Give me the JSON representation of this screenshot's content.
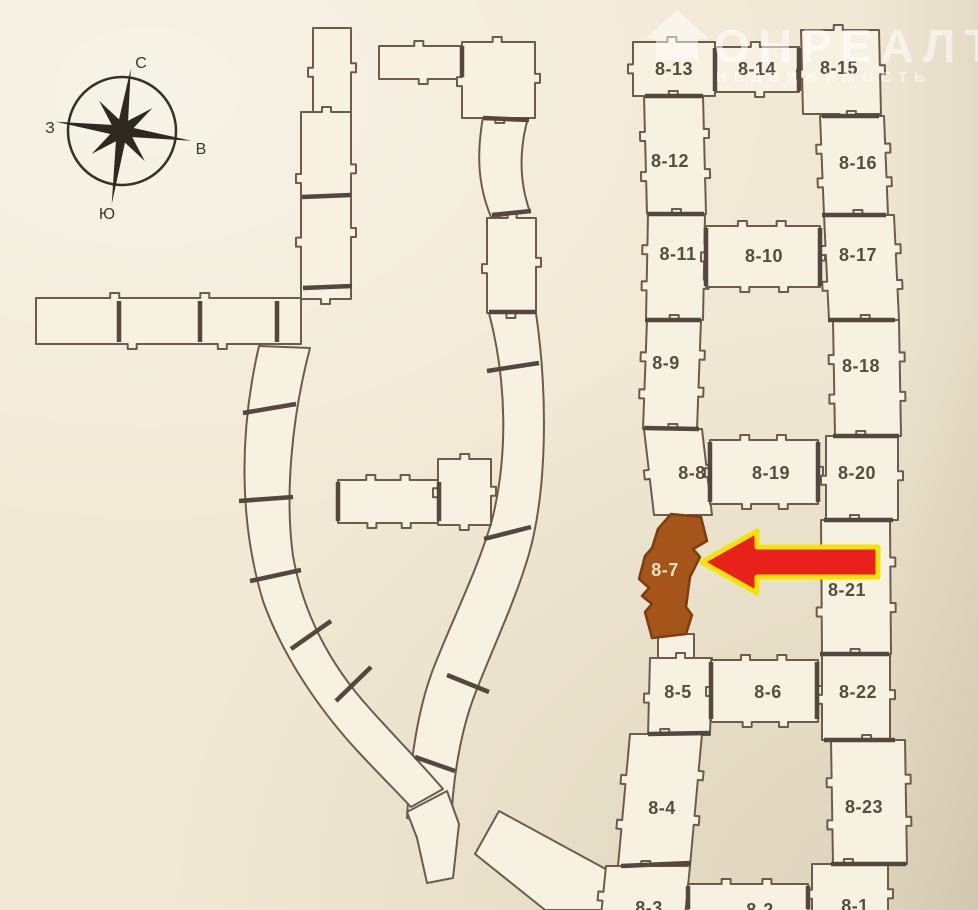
{
  "compass": {
    "north": "С",
    "east": "В",
    "south": "Ю",
    "west": "З"
  },
  "watermark": {
    "brand": "ОНРЕАЛТ",
    "subtitle": "НЕДВИЖИМОСТЬ"
  },
  "plan": {
    "highlight": {
      "label": "8-7"
    },
    "blocks": {
      "b8_1": "8-1",
      "b8_2": "8-2",
      "b8_3": "8-3",
      "b8_4": "8-4",
      "b8_5": "8-5",
      "b8_6": "8-6",
      "b8_8": "8-8",
      "b8_9": "8-9",
      "b8_10": "8-10",
      "b8_11": "8-11",
      "b8_12": "8-12",
      "b8_13": "8-13",
      "b8_14": "8-14",
      "b8_15": "8-15",
      "b8_16": "8-16",
      "b8_17": "8-17",
      "b8_18": "8-18",
      "b8_19": "8-19",
      "b8_20": "8-20",
      "b8_21": "8-21",
      "b8_22": "8-22",
      "b8_23": "8-23"
    },
    "colors": {
      "paper": "#f1e9d5",
      "block_fill": "#f7f1e1",
      "outline": "#6d5c4b",
      "divider": "#54483e",
      "highlight_fill": "#a5541a",
      "highlight_outline": "#7c3d0f",
      "arrow_red": "#e8211a",
      "arrow_yellow": "#f3e405"
    }
  }
}
